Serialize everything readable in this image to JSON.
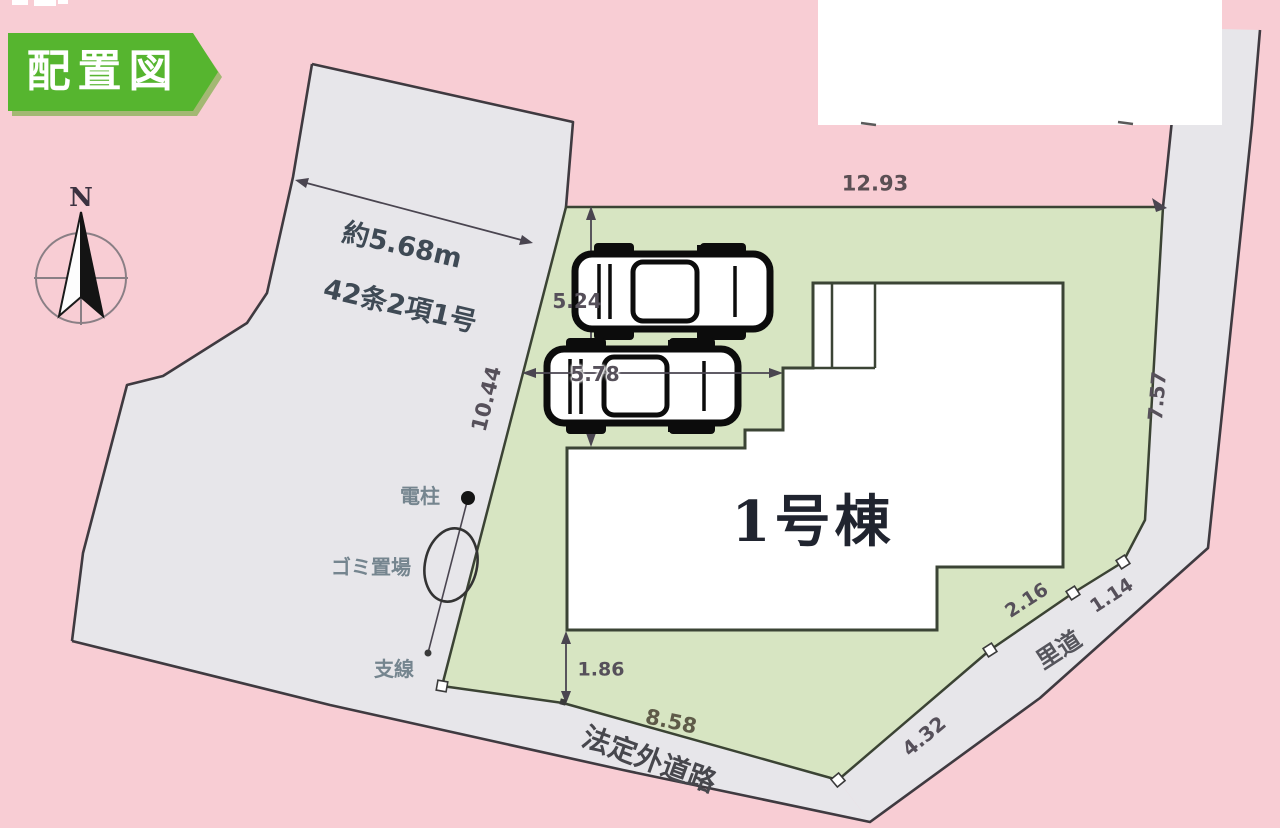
{
  "badge": {
    "label": "配置図"
  },
  "compass": {
    "north_label": "N"
  },
  "roads": {
    "west": {
      "width_label": "約5.68m",
      "classification": "42条2項1号"
    },
    "south": {
      "name": "法定外道路"
    },
    "east": {
      "name": "里道"
    }
  },
  "building": {
    "name": "1号棟"
  },
  "features": {
    "utility_pole": "電柱",
    "garbage_area": "ゴミ置場",
    "guy_wire": "支線"
  },
  "dimensions": {
    "north_boundary_m": "12.93",
    "west_boundary_m": "10.44",
    "east_boundary_m": "7.57",
    "south_boundary_m": "8.58",
    "southeast_boundary_m": "4.32",
    "east_segment_m": "2.16",
    "east_road_width_m": "1.14",
    "parking_depth_m": "5.24",
    "parking_width_m": "5.78",
    "south_offset_m": "1.86"
  },
  "colors": {
    "background_pink": "#f8cdd4",
    "road_gray": "#e7e6ea",
    "plot_green": "#d7e5c2",
    "badge_green": "#56b52f",
    "outline_dark": "#3f3a40"
  }
}
